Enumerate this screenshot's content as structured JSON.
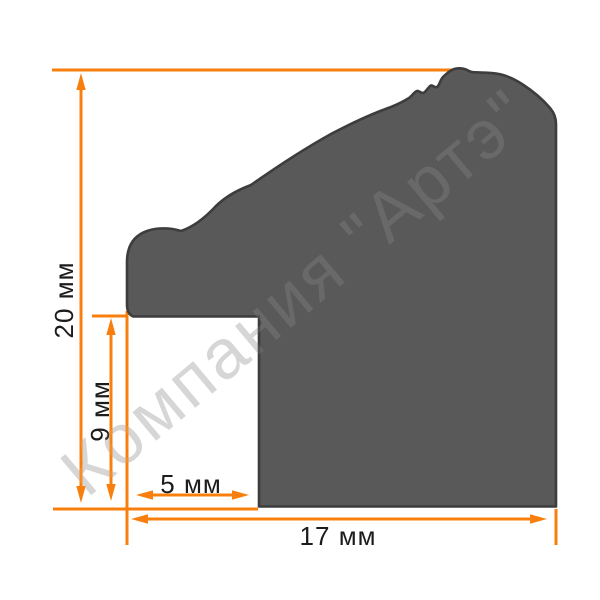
{
  "diagram": {
    "subject": "frame-moulding-profile-cross-section",
    "watermark": {
      "text": "Компания \"Артэ\""
    },
    "dimensions": {
      "overall_height": {
        "label": "20 мм",
        "value": 20,
        "unit": "мм"
      },
      "rabbet_height": {
        "label": "9 мм",
        "value": 9,
        "unit": "мм"
      },
      "rabbet_width": {
        "label": "5 мм",
        "value": 5,
        "unit": "мм"
      },
      "overall_width": {
        "label": "17 мм",
        "value": 17,
        "unit": "мм"
      }
    }
  },
  "colors": {
    "background": "#FFFFFF",
    "profile_fill": "#595959",
    "profile_stroke": "#3D3D3D",
    "dimension": "#F87F0E",
    "dimension_text": "#1C1C1C",
    "watermark": "#D2D2D2"
  }
}
